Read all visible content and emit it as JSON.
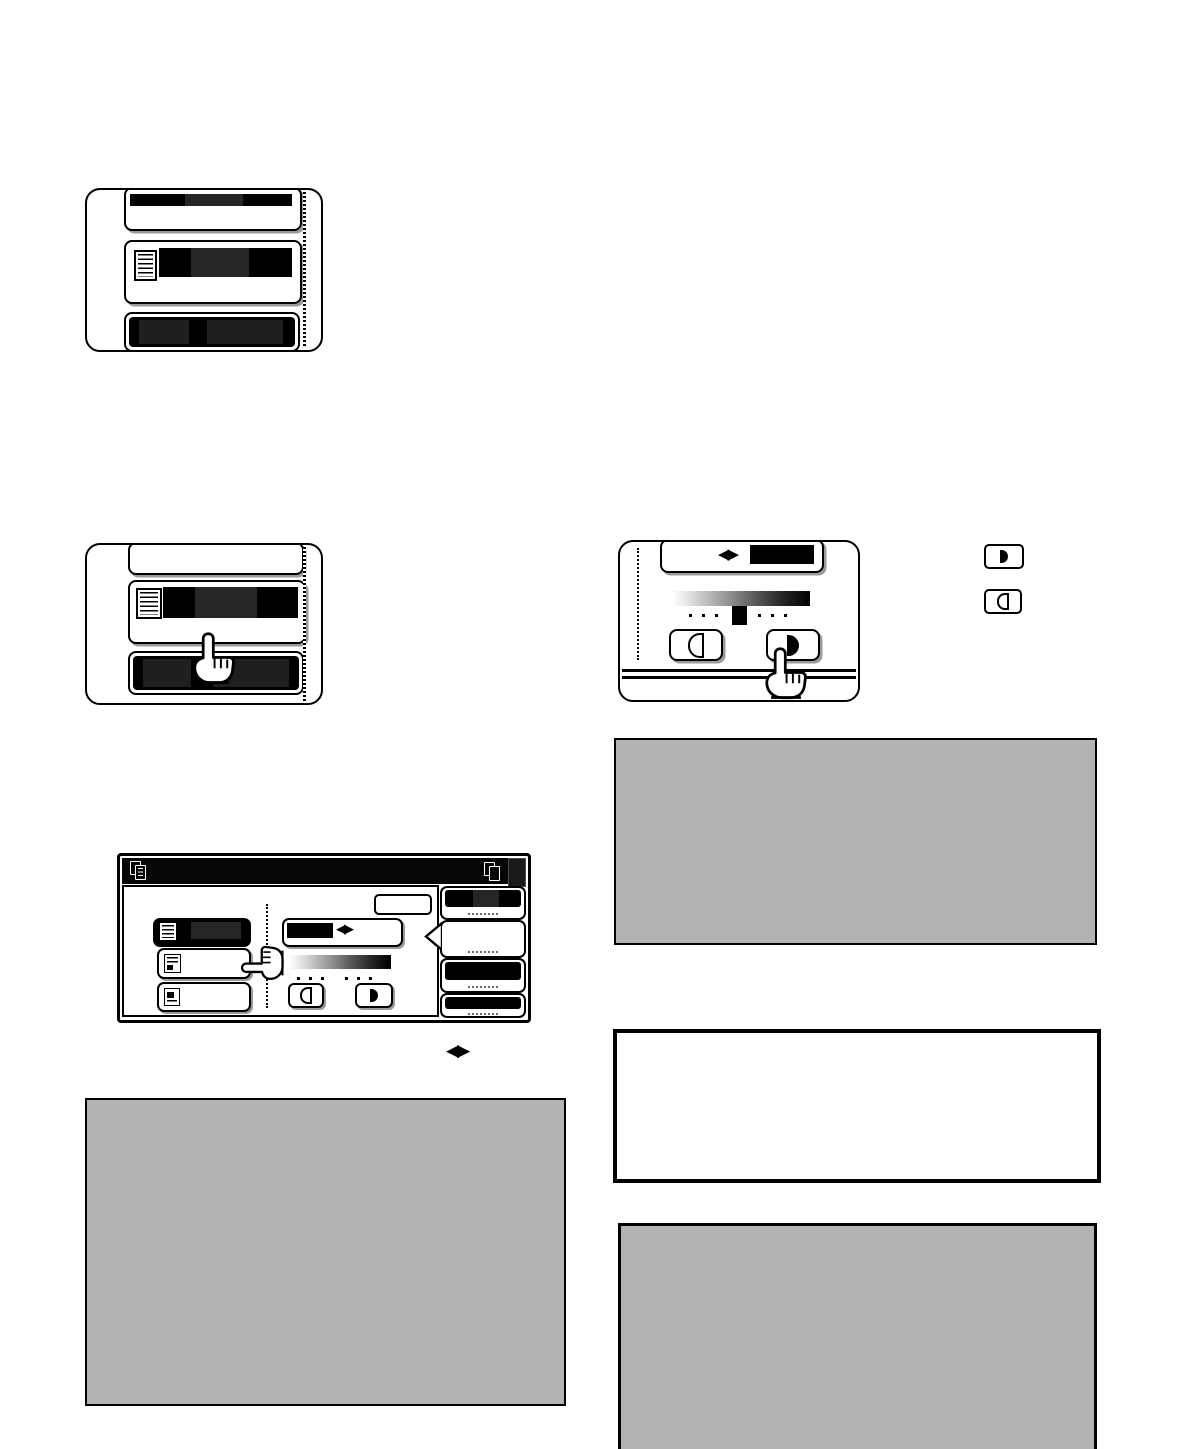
{
  "document": {
    "kind": "copier-operation-manual-page",
    "background": "#ffffff",
    "note": "all body text on the page is blanked out; only illustrations remain"
  },
  "colors": {
    "ink": "#000000",
    "redact_black": "#000000",
    "redact_dark": "#262626",
    "note_gray": "#b3b3b3",
    "shadow_gray": "#9b9b9b",
    "screen_bar": "#060606"
  },
  "icons": {
    "arrow_pair": "◀▶",
    "copy_icon": "document-copy",
    "printer_icon": "printer",
    "hand_up": "pointing-hand-up",
    "hand_left": "pointing-hand-left",
    "lighten": "left-half-outline-circle",
    "darken": "right-half-filled-circle",
    "text_original": "text-lines-page",
    "text_photo_original": "text-and-photo-page",
    "photo_original": "photo-page"
  },
  "panel_step1": {
    "rows": 3,
    "row1": "redacted-label-button",
    "row2": "document-icon-button-redacted-label",
    "row3": "selected-black-button"
  },
  "panel_step2": {
    "rows": 3,
    "row1": "empty-button",
    "row2": "document-icon-button-redacted-label",
    "row3": "selected-black-button",
    "hand_target": "row2-bottom-edge"
  },
  "panel_step3_exposure": {
    "header_button": {
      "icon": "◀▶",
      "label_redacted": true
    },
    "scale": {
      "slots": 7,
      "dots_left": 3,
      "dots_right": 3,
      "marker_slot": 4
    },
    "keys": [
      {
        "name": "lighten"
      },
      {
        "name": "darken"
      }
    ],
    "hand_target": "darken-key"
  },
  "inline_keys": {
    "first": "darken",
    "second": "lighten"
  },
  "touchscreen": {
    "statusbar": {
      "left_icon": "document-copy",
      "right_icon": "printer",
      "corner_key": "dark-square"
    },
    "ok_button": {
      "label_redacted": true
    },
    "mode_buttons": [
      {
        "icon": "text",
        "selected": true
      },
      {
        "icon": "text-photo",
        "selected": false
      },
      {
        "icon": "photo",
        "selected": false
      }
    ],
    "exposure": {
      "header_icon": "◀▶",
      "dots": 6,
      "keys": [
        {
          "name": "lighten"
        },
        {
          "name": "darken"
        }
      ]
    },
    "right_tabs": [
      {
        "selected": true,
        "label": "dotted-redacted"
      },
      {
        "selected": false,
        "label": "dotted-redacted",
        "pointer_to_main": true
      },
      {
        "selected": true,
        "label": "dotted-redacted"
      },
      {
        "selected": true,
        "label": "dotted-redacted"
      }
    ],
    "hand": "pointing-left-at-mode-buttons"
  },
  "inline_diamond_icon": "◀▶",
  "note_boxes": [
    {
      "position": "left-bottom",
      "fill": "#b3b3b3"
    },
    {
      "position": "right-top",
      "fill": "#b3b3b3"
    },
    {
      "position": "right-middle",
      "fill": "#ffffff",
      "border": "thick-black"
    },
    {
      "position": "right-bottom",
      "fill": "#b3b3b3",
      "clipped_at_page_bottom": true
    }
  ]
}
